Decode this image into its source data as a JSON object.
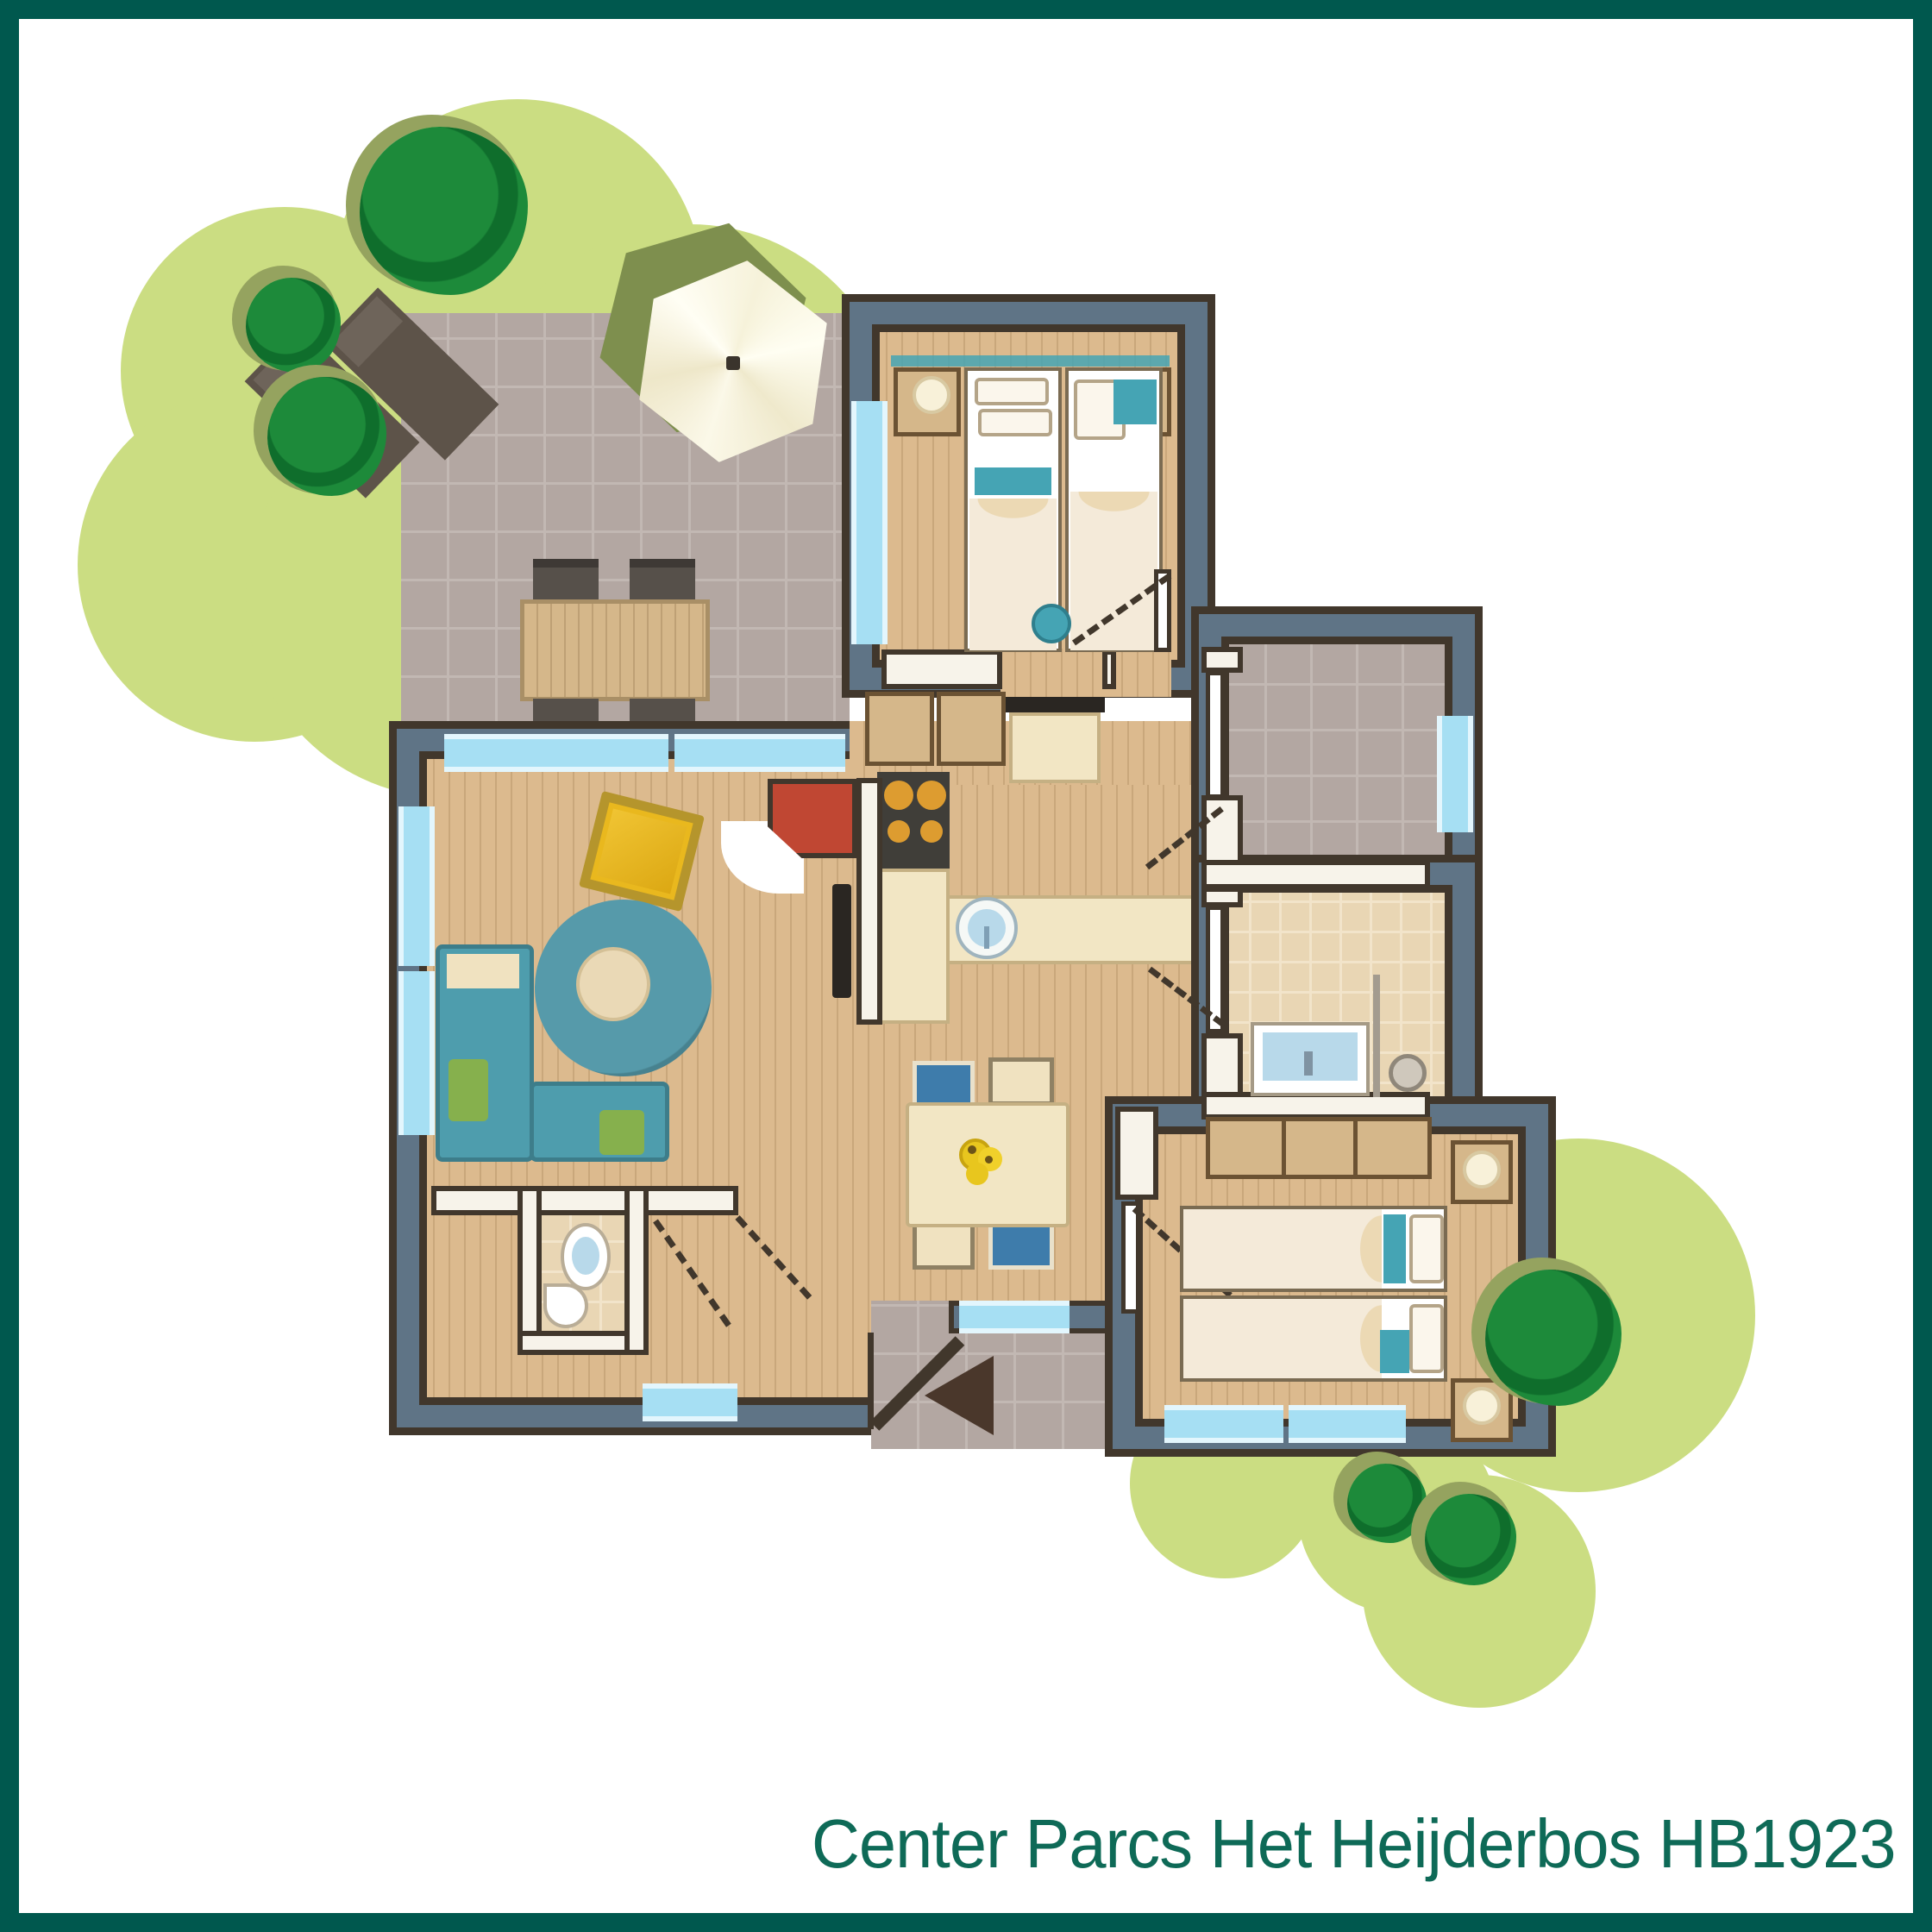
{
  "caption": {
    "text": "Center Parcs Het Heijderbos HB1923"
  },
  "colors": {
    "frame": "#00584e",
    "caption": "#0e6a57",
    "garden_green": "#cbdd82",
    "tree_green": "#1d8a3a",
    "tree_dark": "#0f6e2c",
    "tree_shadow": "#95a35f",
    "terrace": "#b3a7a2",
    "terrace_line": "#c2b8b3",
    "wall_slate": "#5f7486",
    "wall_dark": "#41372c",
    "partition_core": "#f7f3ea",
    "window_blue": "#a6dff3",
    "window_pale": "#e3f6fd",
    "wood": "#dcba8e",
    "wood_line": "#c9a77b",
    "tile": "#e9d6b4",
    "tile_line": "#f2e4ca",
    "counter_cream": "#f2e6c4",
    "cabinet_tan": "#d5b78a",
    "cabinet_edge": "#6b5233",
    "hob_dark": "#403e39",
    "burner_orange": "#dd9c30",
    "fireplace_red": "#c04733",
    "sofa_teal": "#4e9dad",
    "cushion_green": "#86b04d",
    "cushion_cream": "#f0e2c0",
    "rug_teal": "#569aaa",
    "table_cream": "#ead9b6",
    "armchair_yellow": "#e9b81e",
    "armchair_frame": "#b5952c",
    "bed_linen": "#f4ead9",
    "pillow": "#fbf6ec",
    "teal_accent": "#45a4b4",
    "lamp": "#f8f1d9",
    "tv_dark": "#2a2622",
    "toilet_blue": "#b8d9ea",
    "arrow_brown": "#4a372b",
    "chair_blue": "#3e7cab",
    "parasol_cream": "#f7f3dd",
    "parasol_olive": "#7e8f4e"
  },
  "elements": {
    "garden": [
      "shrub-mass",
      "tree",
      "parasol",
      "sun-lounger",
      "outdoor-dining-set"
    ],
    "rooms": [
      "terrace",
      "bedroom-top",
      "living-room",
      "kitchen",
      "dining-area",
      "entry-hall",
      "wc",
      "storage-room",
      "bathroom",
      "bedroom-bottom",
      "entrance-porch"
    ],
    "furniture": [
      "single-bed",
      "nightstand",
      "lamp",
      "dressing-table",
      "stool",
      "wardrobe",
      "l-shaped-sofa",
      "round-rug",
      "coffee-table",
      "armchair",
      "fireplace",
      "tv",
      "kitchen-counter",
      "hob",
      "kitchen-sink",
      "dining-table",
      "dining-chair",
      "toilet",
      "corner-basin",
      "vanity-sink",
      "shower",
      "flower-vase"
    ],
    "symbols": [
      "window",
      "door-leaf",
      "door-swing",
      "entrance-arrow"
    ]
  }
}
